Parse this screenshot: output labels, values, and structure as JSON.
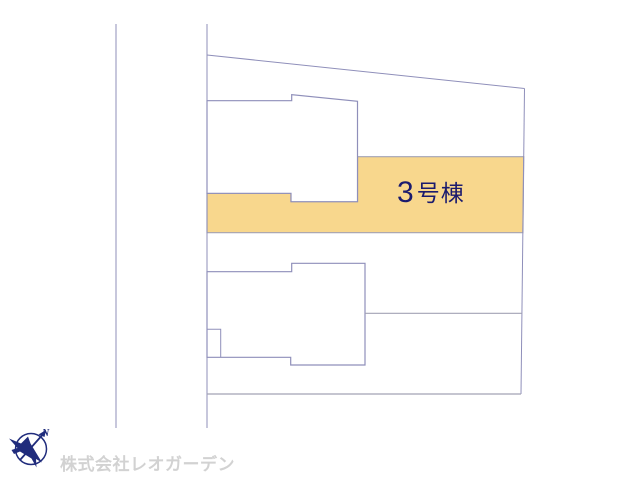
{
  "map": {
    "building_label": {
      "number": "3",
      "suffix": "号棟"
    },
    "colors": {
      "highlight_fill": "#F8D78D",
      "boundary_line": "#8F8FBA",
      "label_text": "#1B1B6E",
      "logo_navy": "#202C7C",
      "watermark_text": "#D2D2D2"
    }
  },
  "compass": {
    "north_label": "N"
  },
  "footer": {
    "company_name": "株式会社レオガーデン"
  }
}
